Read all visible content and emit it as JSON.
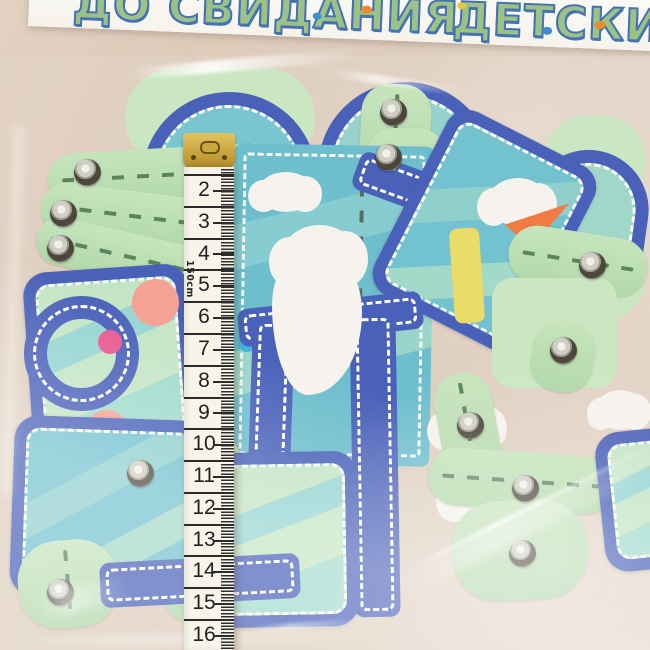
{
  "scene": {
    "description": "Photo of a transparent plastic bag holding a stack of die-cut paper garland pieces (mint-green strips with metal eyelets, blue frames and arches with white dashed borders, teal wavy panels, clouds, pink circles). A yellow measuring tape lies vertically over the bag. A white kindergarten farewell banner hangs above.",
    "background": {
      "wall_color": "#dbc9b8"
    }
  },
  "banner": {
    "text_left": "ДО СВИДАНИЯ",
    "text_right": "ДЕТСКИЙ СА",
    "letter_color": "#9cc288",
    "letter_outline_color": "#4472b2",
    "strip_color": "#f8f5ef"
  },
  "tape": {
    "numbers": [
      "2",
      "3",
      "4",
      "5",
      "6",
      "7",
      "8",
      "9",
      "10",
      "11",
      "12",
      "13",
      "14",
      "15",
      "16"
    ],
    "unit_label": "150cm",
    "tape_color": "#f7f4ea",
    "clip_color": "#c29c37",
    "mark_color": "#2b2b2b"
  },
  "pieces": {
    "colors": {
      "mint_green": "#b7dcae",
      "blue": "#3b54b4",
      "teal": "#62b9c9",
      "cloud_white": "#f6f1ec",
      "coral_pink": "#f59a8a",
      "magenta": "#e84a86",
      "sky_blue_dot": "#30aee0",
      "orange": "#ef7033",
      "yellow": "#e8d95c",
      "eyelet_metal": "#c9c8bd"
    },
    "eyelets": [
      [
        87,
        172
      ],
      [
        63,
        213
      ],
      [
        60,
        248
      ],
      [
        393,
        112
      ],
      [
        388,
        157
      ],
      [
        592,
        265
      ],
      [
        563,
        350
      ],
      [
        470,
        425
      ],
      [
        525,
        488
      ],
      [
        522,
        553
      ],
      [
        140,
        473
      ],
      [
        60,
        592
      ]
    ]
  }
}
